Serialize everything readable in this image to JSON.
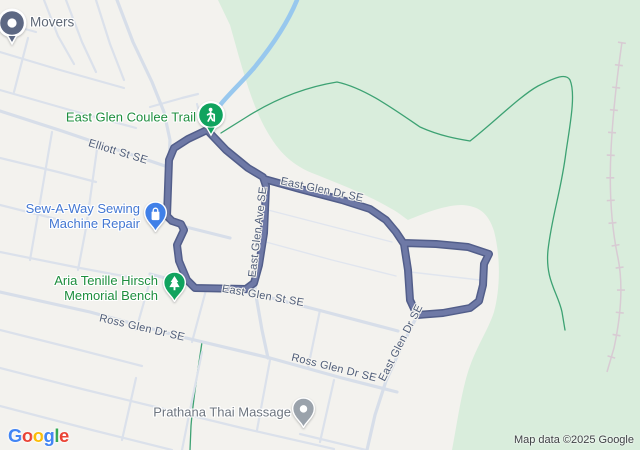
{
  "pois": [
    {
      "name": "Movers",
      "icon": "movers-dot-pin",
      "label_color": "#5E6876"
    },
    {
      "name": "East Glen Coulee Trail",
      "icon": "hiker-pin",
      "label_color": "#1E8E3E"
    },
    {
      "name": "Sew-A-Way Sewing Machine Repair",
      "lines": [
        "Sew-A-Way Sewing",
        "Machine Repair"
      ],
      "icon": "shopping-pin",
      "label_color": "#4377D2"
    },
    {
      "name": "Aria Tenille Hirsch Memorial Bench",
      "lines": [
        "Aria Tenille Hirsch",
        "Memorial Bench"
      ],
      "icon": "tree-pin",
      "label_color": "#1E8E3E"
    },
    {
      "name": "Prathana Thai Massage",
      "icon": "generic-pin",
      "label_color": "#6D757F"
    }
  ],
  "streets": [
    {
      "name": "Elliott St SE"
    },
    {
      "name": "East Glen Dr SE"
    },
    {
      "name": "East Glen Ave SE"
    },
    {
      "name": "East Glen St SE"
    },
    {
      "name": "Ross Glen Dr SE"
    },
    {
      "name": "Ross Glen Dr SE"
    },
    {
      "name": "East Glen Dr SE"
    }
  ],
  "attribution": {
    "logo": [
      "G",
      "o",
      "o",
      "g",
      "l",
      "e"
    ],
    "copyright": "Map data ©2025 Google"
  },
  "colors": {
    "land": "#F3F2EE",
    "park": "#D9EDDC",
    "road": "#D7DEE9",
    "route_casing": "#525E8A",
    "route_core": "#6E79A6",
    "trail": "#3DA273",
    "creek": "#98C8EE",
    "railway": "#D8CBD3",
    "street_label": "#4F5D79",
    "copyright": "#3F4245",
    "pin_blue": "#4080E8",
    "pin_green": "#10A35E",
    "pin_gray": "#9AA2AB",
    "pin_slate": "#5D6883",
    "google_blue": "#4285F4",
    "google_red": "#EA4335",
    "google_yellow": "#FBBC05",
    "google_green": "#34A853"
  }
}
